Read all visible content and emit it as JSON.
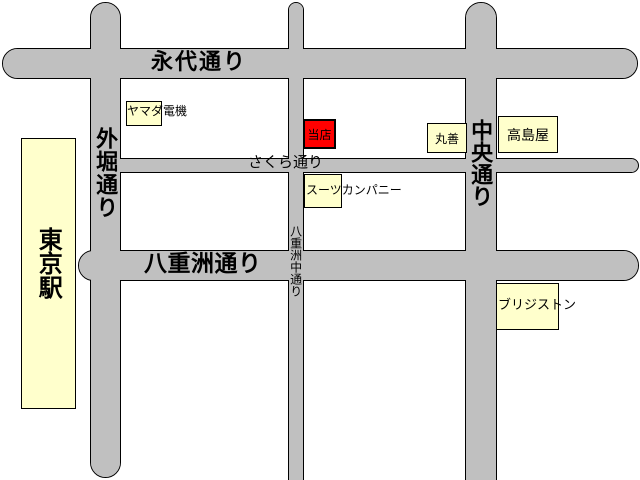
{
  "colors": {
    "background": "#ffffff",
    "road": "#c0c0c0",
    "road_outline": "#000000",
    "building_fill": "#ffffcc",
    "store_highlight": "#ff0000",
    "text": "#000000"
  },
  "roads": {
    "eitai": {
      "name": "永代通り"
    },
    "yaesu": {
      "name": "八重洲通り"
    },
    "sakura": {
      "name": "さくら通り"
    },
    "sotobori": {
      "name": "外堀通り"
    },
    "chuo": {
      "name": "中央通り"
    },
    "yaesu_naka": {
      "name": "八重洲中通り"
    }
  },
  "places": {
    "tokyo_station": {
      "name": "東京駅"
    },
    "yamada_denki": {
      "name": "ヤマダ電機"
    },
    "our_store": {
      "name": "当店"
    },
    "maruzen": {
      "name": "丸善"
    },
    "takashimaya": {
      "name": "高島屋"
    },
    "suit_company": {
      "name": "スーツカンパニー"
    },
    "bridgestone": {
      "name": "ブリジストン"
    }
  }
}
